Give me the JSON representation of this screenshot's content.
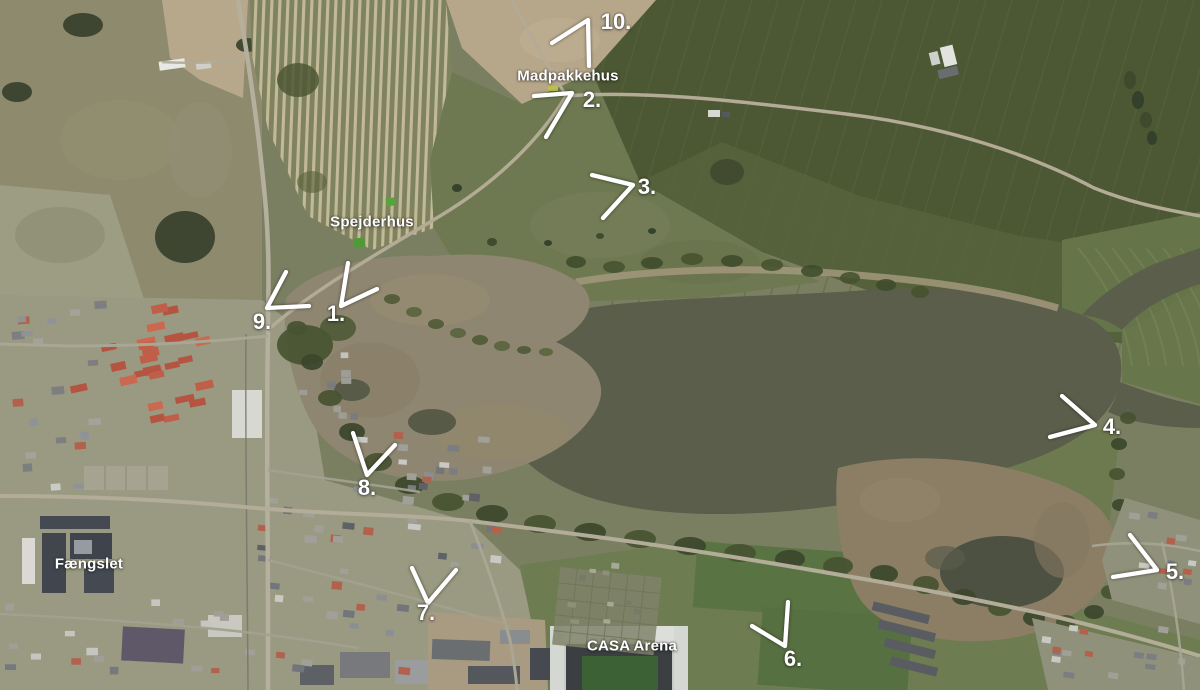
{
  "map": {
    "colors": {
      "annotation": "#ffffff",
      "water": "#5b5e4a",
      "marsh": "#8e8670",
      "dark_field": "#4c5733",
      "pasture": "#6e7951",
      "urban": "#999a81",
      "red_roofs": "#c05f49"
    },
    "place_labels": [
      {
        "id": "madpakkehus",
        "text": "Madpakkehus",
        "x": 568,
        "y": 76
      },
      {
        "id": "spejderhus",
        "text": "Spejderhus",
        "x": 372,
        "y": 222
      },
      {
        "id": "faengslet",
        "text": "Fængslet",
        "x": 89,
        "y": 564
      },
      {
        "id": "casa-arena",
        "text": "CASA Arena",
        "x": 632,
        "y": 646
      }
    ],
    "markers": [
      {
        "number": "1.",
        "x": 336,
        "y": 314,
        "arrow": [
          [
            348,
            263
          ],
          [
            341,
            306
          ],
          [
            377,
            289
          ]
        ]
      },
      {
        "number": "2.",
        "x": 592,
        "y": 100,
        "arrow": [
          [
            534,
            96
          ],
          [
            572,
            93
          ],
          [
            546,
            137
          ]
        ]
      },
      {
        "number": "3.",
        "x": 647,
        "y": 187,
        "arrow": [
          [
            592,
            175
          ],
          [
            633,
            185
          ],
          [
            603,
            218
          ]
        ]
      },
      {
        "number": "4.",
        "x": 1112,
        "y": 427,
        "arrow": [
          [
            1062,
            396
          ],
          [
            1095,
            425
          ],
          [
            1050,
            437
          ]
        ]
      },
      {
        "number": "5.",
        "x": 1175,
        "y": 572,
        "arrow": [
          [
            1130,
            535
          ],
          [
            1157,
            570
          ],
          [
            1113,
            577
          ]
        ]
      },
      {
        "number": "6.",
        "x": 793,
        "y": 659,
        "arrow": [
          [
            788,
            602
          ],
          [
            785,
            646
          ],
          [
            752,
            626
          ]
        ]
      },
      {
        "number": "7.",
        "x": 426,
        "y": 613,
        "arrow": [
          [
            412,
            568
          ],
          [
            428,
            603
          ],
          [
            456,
            570
          ]
        ]
      },
      {
        "number": "8.",
        "x": 367,
        "y": 488,
        "arrow": [
          [
            353,
            433
          ],
          [
            367,
            475
          ],
          [
            395,
            445
          ]
        ]
      },
      {
        "number": "9.",
        "x": 262,
        "y": 322,
        "arrow": [
          [
            286,
            272
          ],
          [
            267,
            308
          ],
          [
            309,
            306
          ]
        ]
      },
      {
        "number": "10.",
        "x": 616,
        "y": 22,
        "arrow": [
          [
            552,
            43
          ],
          [
            588,
            20
          ],
          [
            589,
            66
          ]
        ]
      }
    ]
  }
}
